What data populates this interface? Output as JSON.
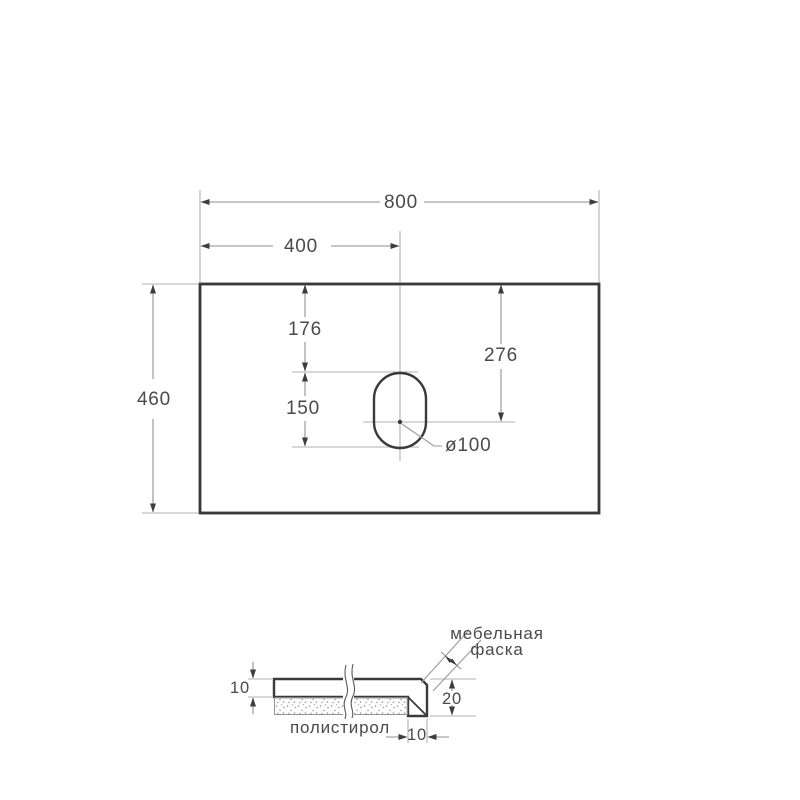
{
  "drawing": {
    "type": "countertop-dimension-drawing",
    "units_scale_note": "values as printed on drawing",
    "top_view": {
      "dim_width": "800",
      "dim_hole_center_from_left": "400",
      "dim_depth": "460",
      "dim_hole_top_offset": "176",
      "dim_hole_center_from_top": "276",
      "dim_hole_length": "150",
      "dim_hole_diameter": "ø100"
    },
    "section_view": {
      "dim_top_thickness": "10",
      "dim_edge_height": "20",
      "dim_edge_width": "10",
      "chamfer_label_line1": "мебельная",
      "chamfer_label_line2": "фаска",
      "substrate_label": "полистирол"
    },
    "colors": {
      "background": "#ffffff",
      "outline": "#3a3a3a",
      "dimension_line": "#8f8f8f",
      "extension_line": "#b2b2b2",
      "arrow": "#3d3d3d",
      "text": "#4a4a4a",
      "hatch": "#4f4f4f",
      "stipple": "#8f8f8f"
    }
  }
}
